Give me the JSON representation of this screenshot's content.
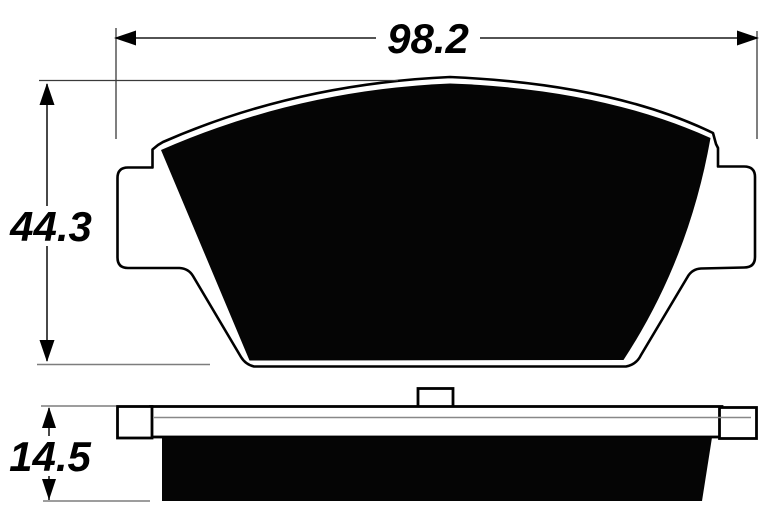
{
  "drawing": {
    "dimensions": {
      "width": "98.2",
      "height": "44.3",
      "thickness": "14.5"
    },
    "colors": {
      "ink": "#000000",
      "background": "#ffffff",
      "pad_fill": "#050505",
      "extension_gray": "#7d7d7d"
    }
  }
}
